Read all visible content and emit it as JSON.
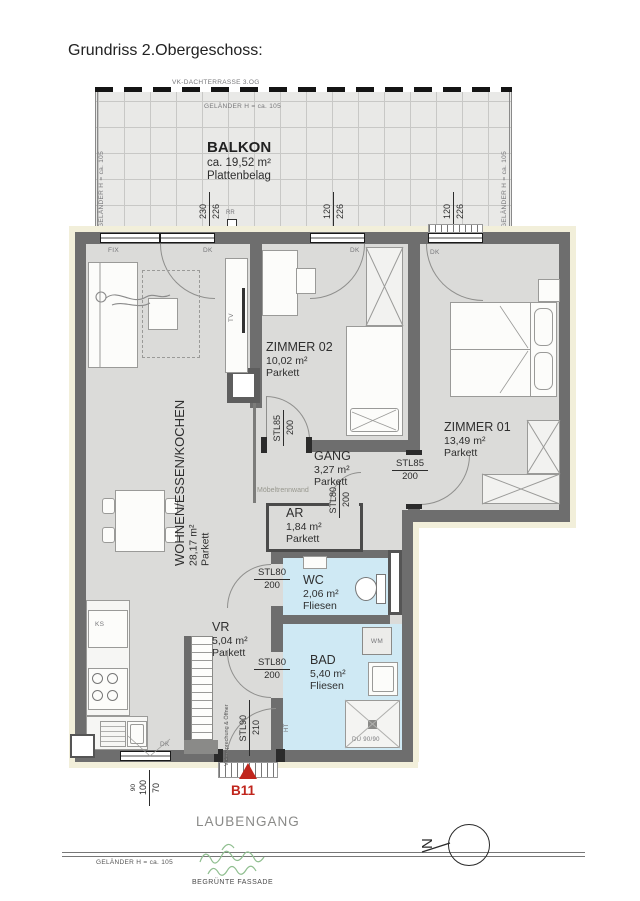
{
  "title": "Grundriss 2.Obergeschoss:",
  "terrace": {
    "label": "VK-DACHTERRASSE 3.OG"
  },
  "railings": {
    "top": "GELÄNDER H = ca. 105",
    "left": "GELÄNDER H = ca. 105",
    "right": "GELÄNDER H = ca. 105",
    "bottom": "GELÄNDER H = ca. 105"
  },
  "balcony": {
    "name": "BALKON",
    "area": "ca. 19,52 m²",
    "floor": "Plattenbelag"
  },
  "rooms": [
    {
      "name": "WOHNEN/ESSEN/KOCHEN",
      "area": "28,17 m²",
      "floor": "Parkett"
    },
    {
      "name": "ZIMMER 02",
      "area": "10,02 m²",
      "floor": "Parkett"
    },
    {
      "name": "ZIMMER 01",
      "area": "13,49 m²",
      "floor": "Parkett"
    },
    {
      "name": "GANG",
      "area": "3,27 m²",
      "floor": "Parkett"
    },
    {
      "name": "AR",
      "area": "1,84 m²",
      "floor": "Parkett"
    },
    {
      "name": "WC",
      "area": "2,06 m²",
      "floor": "Fliesen"
    },
    {
      "name": "BAD",
      "area": "5,40 m²",
      "floor": "Fliesen"
    },
    {
      "name": "VR",
      "area": "5,04 m²",
      "floor": "Parkett"
    }
  ],
  "window_dims": [
    {
      "w": "230",
      "h": "226"
    },
    {
      "w": "120",
      "h": "226"
    },
    {
      "w": "120",
      "h": "226"
    }
  ],
  "small_window_dim": {
    "sill": "90",
    "w": "100",
    "h": "70"
  },
  "door_dims": {
    "zimmer02": {
      "type": "STL85",
      "h": "200"
    },
    "zimmer01": {
      "type": "STL85",
      "h": "200"
    },
    "ar": {
      "type": "STL80",
      "h": "200"
    },
    "wc": {
      "type": "STL80",
      "h": "200"
    },
    "bad": {
      "type": "STL80",
      "h": "200"
    },
    "entry": {
      "type": "STL90",
      "h": "210"
    }
  },
  "labels": {
    "fix": "FIX",
    "dk": "DK",
    "tv": "TV",
    "ks": "KS",
    "wm": "WM",
    "ht": "HT",
    "rr": "RR",
    "shower": "DU 90/90",
    "partition": "Möbeltrennwand",
    "entry_note": "Videosprechung & Öffner"
  },
  "entrance": {
    "unit": "B11"
  },
  "exterior": {
    "walkway": "LAUBENGANG",
    "railing": "GELÄNDER H = ca. 105",
    "facade": "BEGRÜNTE FASSADE"
  },
  "north": {
    "label": "N"
  },
  "colors": {
    "wall": "#6e6e6e",
    "room": "#dbdbd9",
    "wet_room": "#cfe9f4",
    "insulation": "#f2efda",
    "accent_red": "#c0251c",
    "greenery": "#8fbe8f"
  }
}
